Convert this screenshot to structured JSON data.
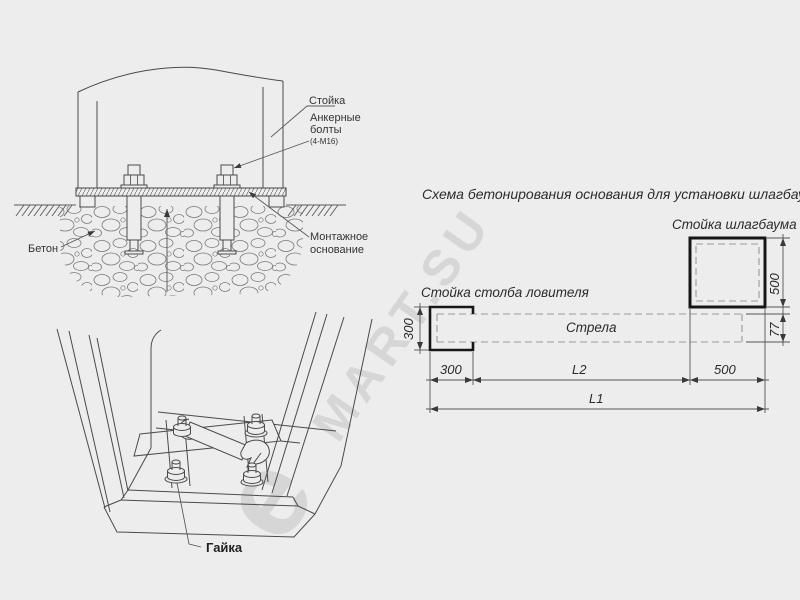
{
  "watermark": {
    "logo_glyph": "e",
    "text": "MART.SU"
  },
  "cross": {
    "labels": {
      "post": "Стойка",
      "bolts1": "Анкерные",
      "bolts2": "болты",
      "bolts_spec": "(4-М16)",
      "concrete": "Бетон",
      "base1": "Монтажное",
      "base2": "основание"
    }
  },
  "persp": {
    "labels": {
      "nut": "Гайка"
    }
  },
  "plan": {
    "title": "Схема бетонирования основания для установки шлагбаума ДорХан",
    "labels": {
      "barrier_post": "Стойка шлагбаума",
      "catcher_post": "Стойка столба ловителя",
      "boom": "Стрела"
    },
    "dims": {
      "left300": "300",
      "bottom300": "300",
      "l2": "L2",
      "bottom500": "500",
      "l1": "L1",
      "right500": "500",
      "boom77": "77"
    }
  }
}
